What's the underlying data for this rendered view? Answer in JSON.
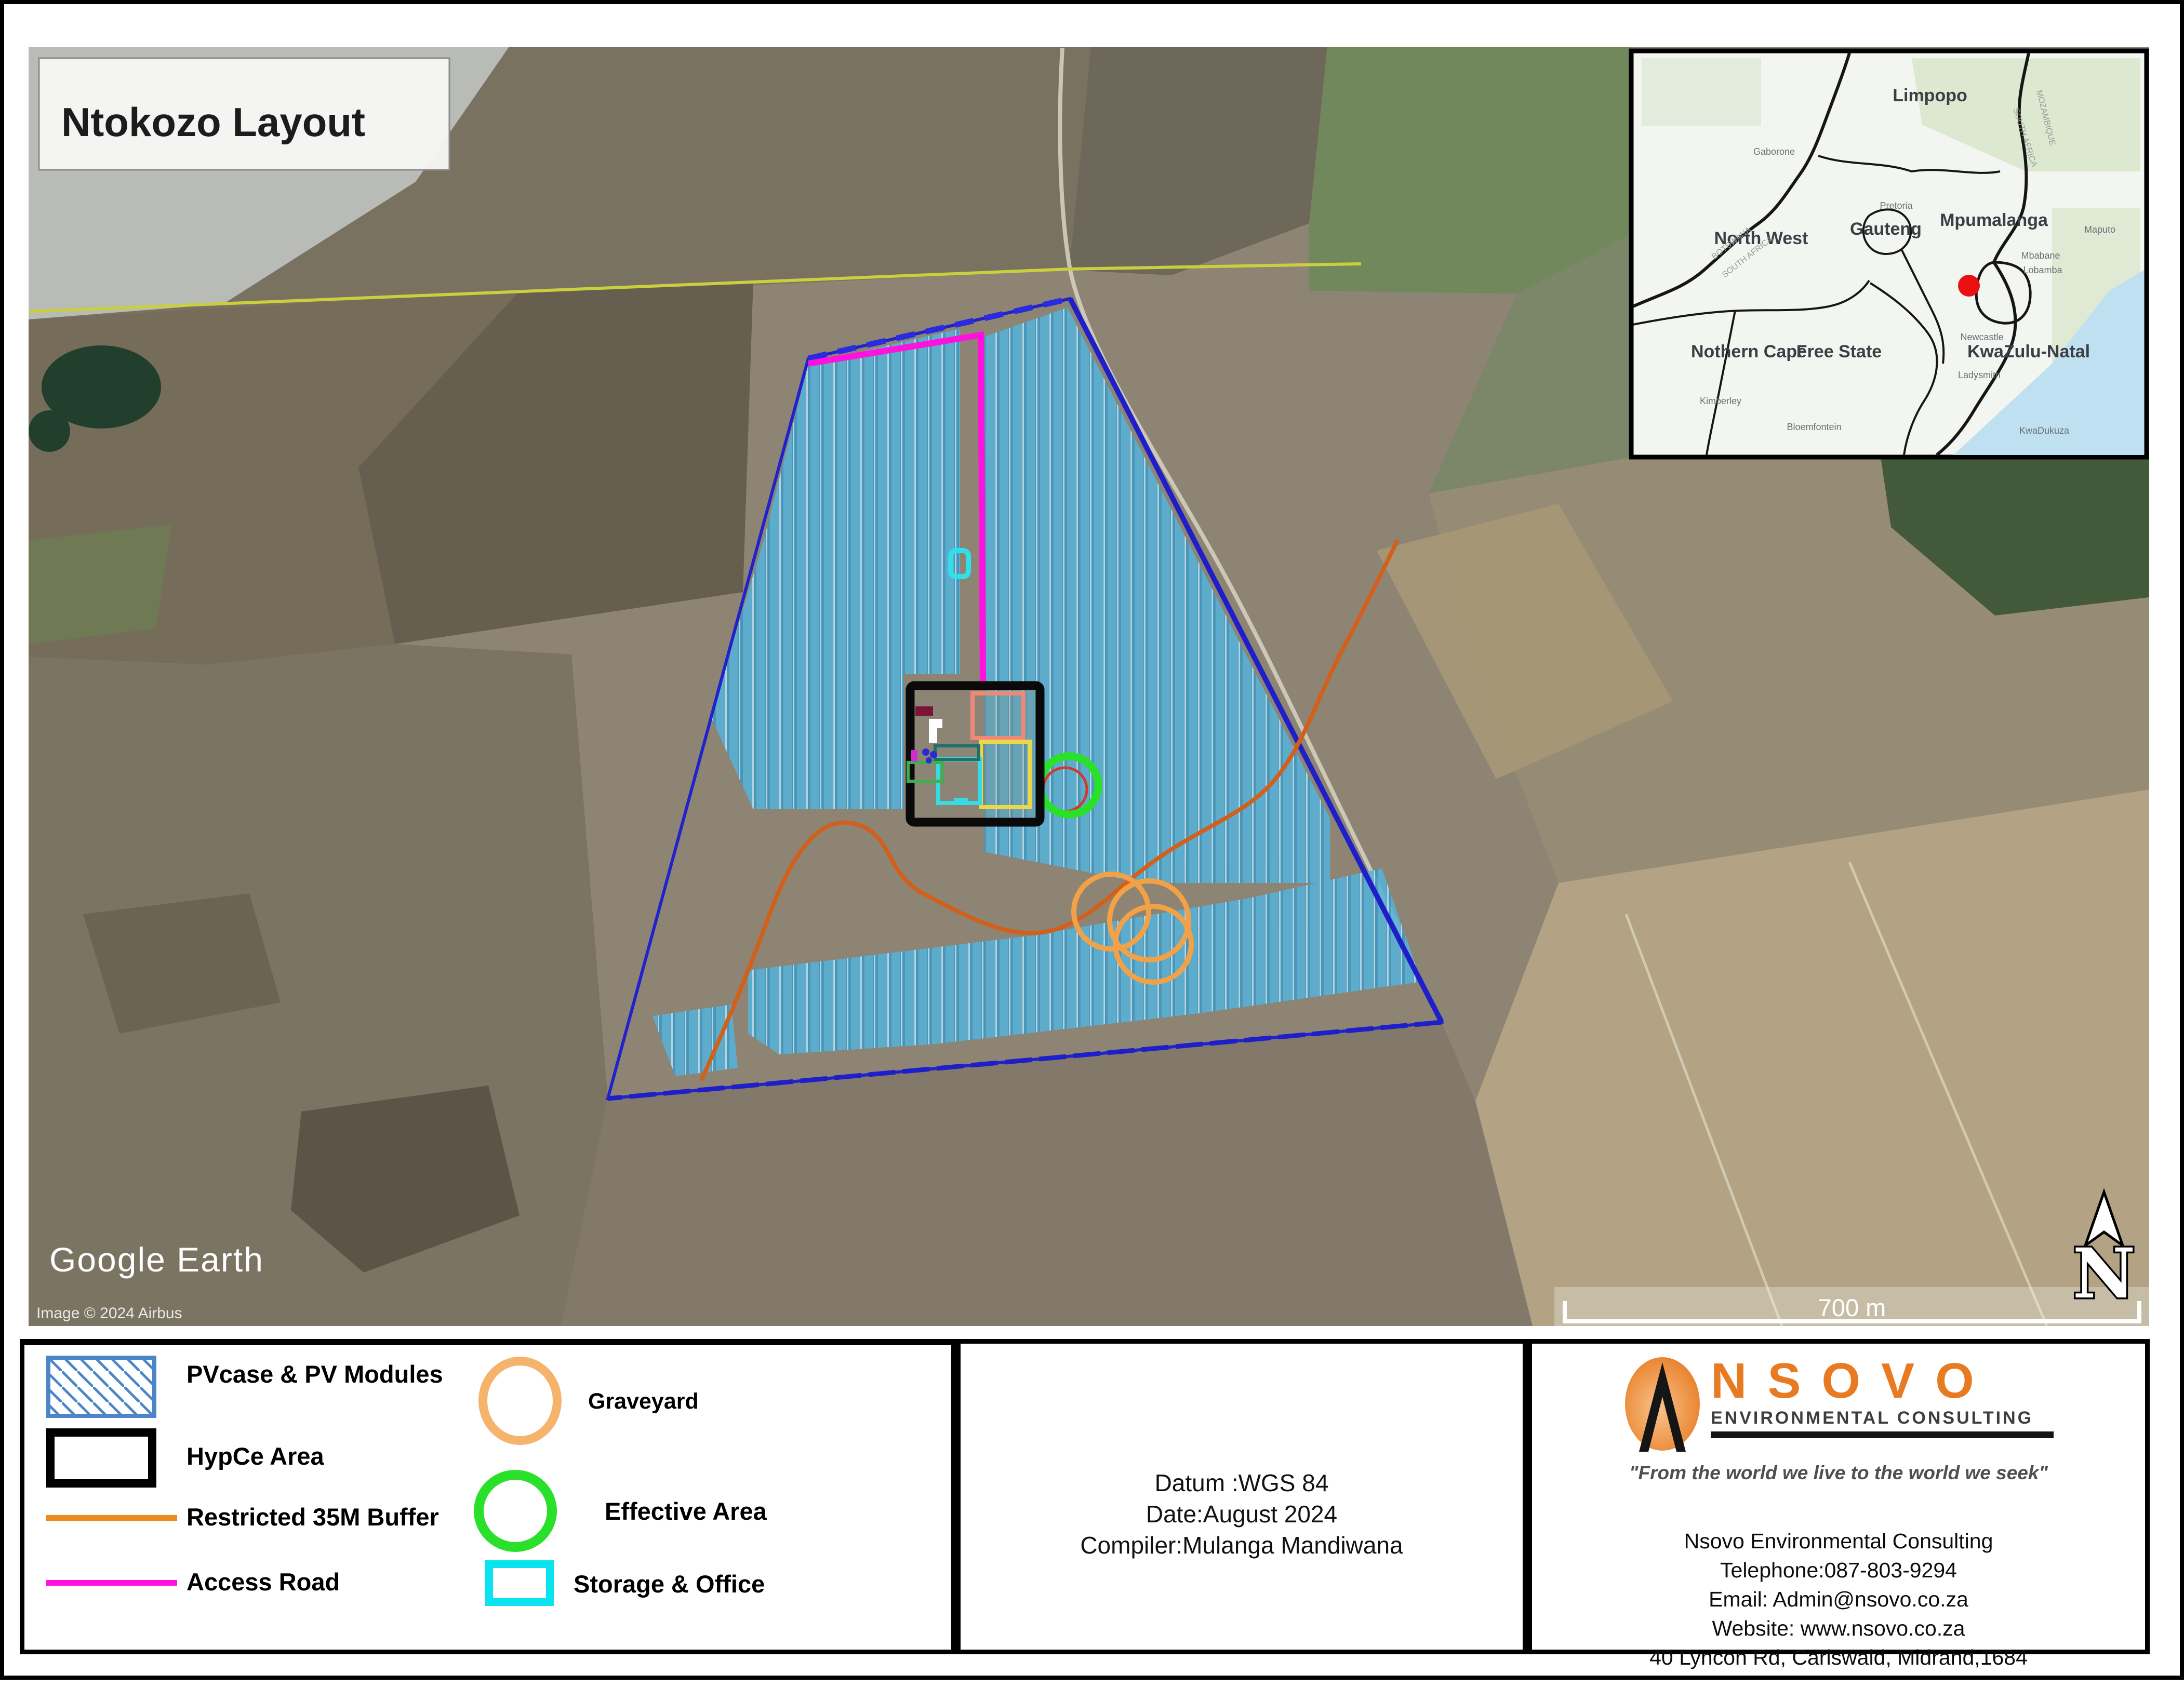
{
  "title": "Ntokozo Layout",
  "map": {
    "credits": {
      "logo": "Google Earth",
      "attribution": "Image © 2024 Airbus"
    },
    "scale_bar": {
      "label": "700 m"
    },
    "north_label": "N"
  },
  "inset": {
    "provinces": [
      "Limpopo",
      "North West",
      "Gauteng",
      "Mpumalanga",
      "Nothern Cape",
      "Free State",
      "KwaZulu-Natal"
    ],
    "cities": [
      "Gaborone",
      "Pretoria",
      "Mbabane",
      "Lobamba",
      "Maputo",
      "Newcastle",
      "Ladysmith",
      "Bloemfontein",
      "Kimberley",
      "KwaDukuza"
    ],
    "border_labels": [
      "BOTSWANA",
      "SOUTH AFRICA",
      "MOZAMBIQUE"
    ],
    "marker_color": "#e81010"
  },
  "legend": {
    "items": [
      {
        "label": "PVcase & PV Modules",
        "swatch": "hatched-rect",
        "color": "#4a86c8"
      },
      {
        "label": "HypCe Area",
        "swatch": "rect-outline",
        "color": "#000000"
      },
      {
        "label": "Restricted 35M Buffer",
        "swatch": "line",
        "color": "#ef8b1d"
      },
      {
        "label": "Access Road",
        "swatch": "line",
        "color": "#ff00dd"
      },
      {
        "label": "Graveyard",
        "swatch": "circle-outline",
        "color": "#f5b36b"
      },
      {
        "label": "Effective Area",
        "swatch": "circle-outline",
        "color": "#2be02b"
      },
      {
        "label": "Storage & Office",
        "swatch": "rect-outline",
        "color": "#0ae4ef"
      }
    ]
  },
  "metadata": {
    "datum": "Datum :WGS 84",
    "date": "Date:August 2024",
    "compiler": "Compiler:Mulanga Mandiwana"
  },
  "company": {
    "logo_name": "NSOVO",
    "logo_sub": "ENVIRONMENTAL CONSULTING",
    "tagline": "\"From the world we live to the world we seek\"",
    "lines": [
      "Nsovo Environmental Consulting",
      "Telephone:087-803-9294",
      "Email: Admin@nsovo.co.za",
      "Website: www.nsovo.co.za",
      "40 Lyncon Rd, Carlswald, Midrand,1684"
    ]
  }
}
